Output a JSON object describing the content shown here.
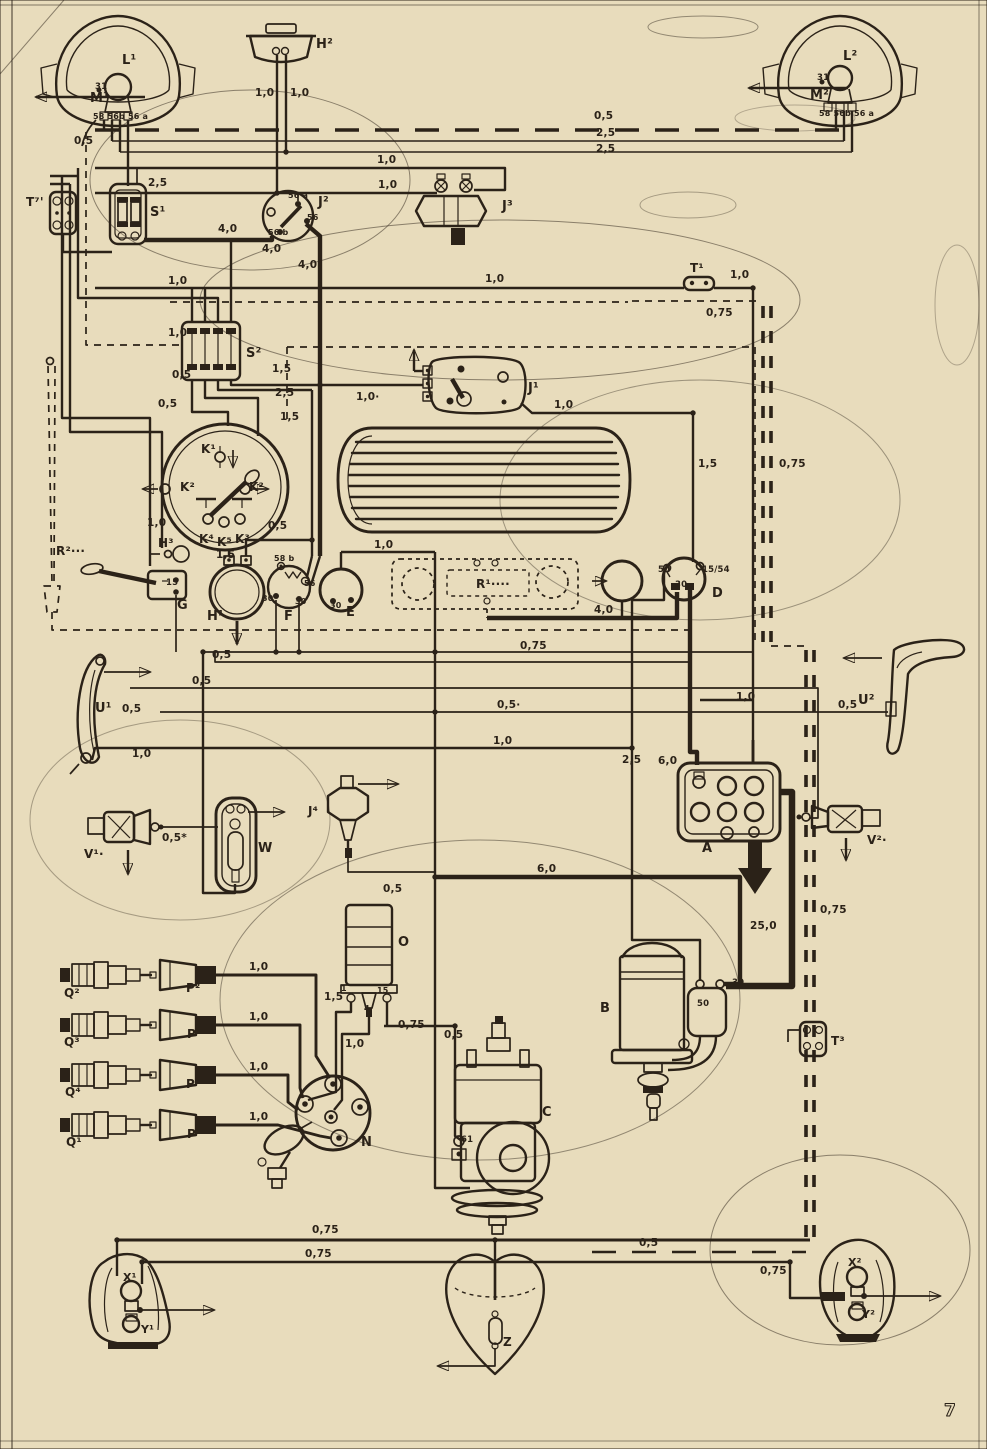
{
  "page": {
    "number": "7"
  },
  "palette": {
    "paper": "#e8dcbc",
    "ink": "#2b2218",
    "smudge": "#9dc9bd"
  },
  "diagram": {
    "labels": [
      {
        "id": "l1",
        "t": "L¹",
        "x": 122,
        "y": 64,
        "s": 13
      },
      {
        "id": "m1",
        "t": "M¹",
        "x": 90,
        "y": 102,
        "s": 13
      },
      {
        "id": "l1-31",
        "t": "31",
        "x": 95,
        "y": 89,
        "s": 8.5
      },
      {
        "id": "l1-58",
        "t": "58 56b 56 a",
        "x": 93,
        "y": 119,
        "s": 8
      },
      {
        "id": "w-l1-05",
        "t": "0,5",
        "x": 74,
        "y": 144,
        "s": 10.5
      },
      {
        "id": "h2",
        "t": "H²",
        "x": 316,
        "y": 48,
        "s": 13
      },
      {
        "id": "w-h2-10a",
        "t": "1,0",
        "x": 255,
        "y": 96,
        "s": 10.5
      },
      {
        "id": "w-h2-10b",
        "t": "1,0",
        "x": 290,
        "y": 96,
        "s": 10.5
      },
      {
        "id": "l2",
        "t": "L²",
        "x": 843,
        "y": 60,
        "s": 13
      },
      {
        "id": "l2-31",
        "t": "31",
        "x": 817,
        "y": 80,
        "s": 8.5
      },
      {
        "id": "m2",
        "t": "M²",
        "x": 810,
        "y": 99,
        "s": 13
      },
      {
        "id": "l2-58",
        "t": "58 56b 56 a",
        "x": 819,
        "y": 116,
        "s": 8
      },
      {
        "id": "w-top-05",
        "t": "0,5",
        "x": 594,
        "y": 119,
        "s": 10.5
      },
      {
        "id": "w-top-25a",
        "t": "2,5",
        "x": 596,
        "y": 136,
        "s": 10.5
      },
      {
        "id": "w-top-25b",
        "t": "2,5",
        "x": 596,
        "y": 152,
        "s": 10.5
      },
      {
        "id": "j3",
        "t": "J³",
        "x": 502,
        "y": 210,
        "s": 13
      },
      {
        "id": "w-j3-10a",
        "t": "1,0",
        "x": 377,
        "y": 163,
        "s": 10.5
      },
      {
        "id": "w-j3-10b",
        "t": "1,0",
        "x": 378,
        "y": 188,
        "s": 10.5
      },
      {
        "id": "t7",
        "t": "T⁷'",
        "x": 26,
        "y": 206,
        "s": 12
      },
      {
        "id": "s1",
        "t": "S¹",
        "x": 150,
        "y": 216,
        "s": 13
      },
      {
        "id": "w-s1-25",
        "t": "2,5",
        "x": 148,
        "y": 186,
        "s": 10.5
      },
      {
        "id": "j2",
        "t": "J²",
        "x": 318,
        "y": 206,
        "s": 13
      },
      {
        "id": "j2-56a",
        "t": "56 a",
        "x": 288,
        "y": 198,
        "s": 8
      },
      {
        "id": "j2-56",
        "t": "56",
        "x": 307,
        "y": 220,
        "s": 8
      },
      {
        "id": "j2-56b",
        "t": "56 b",
        "x": 268,
        "y": 235,
        "s": 8
      },
      {
        "id": "w-j2-40a",
        "t": "4,0",
        "x": 218,
        "y": 232,
        "s": 10.5
      },
      {
        "id": "w-j2-40b",
        "t": "4,0",
        "x": 262,
        "y": 252,
        "s": 10.5
      },
      {
        "id": "w-j2-40c",
        "t": "4,0",
        "x": 298,
        "y": 268,
        "s": 10.5
      },
      {
        "id": "t1",
        "t": "T¹",
        "x": 690,
        "y": 272,
        "s": 12
      },
      {
        "id": "w-t1-10",
        "t": "1,0",
        "x": 730,
        "y": 278,
        "s": 10.5
      },
      {
        "id": "w-t1-075",
        "t": "0,75",
        "x": 706,
        "y": 316,
        "s": 10.5
      },
      {
        "id": "w-mid-10",
        "t": "1,0",
        "x": 485,
        "y": 282,
        "s": 10.5
      },
      {
        "id": "w-left-10",
        "t": "1,0",
        "x": 168,
        "y": 284,
        "s": 10.5
      },
      {
        "id": "s2",
        "t": "S²",
        "x": 246,
        "y": 357,
        "s": 13
      },
      {
        "id": "w-s2-15a",
        "t": "1,5",
        "x": 272,
        "y": 372,
        "s": 10.5
      },
      {
        "id": "w-s2-25",
        "t": "2,5",
        "x": 275,
        "y": 396,
        "s": 10.5
      },
      {
        "id": "w-s2-15b",
        "t": "1,5",
        "x": 280,
        "y": 420,
        "s": 10.5
      },
      {
        "id": "w-s2-05a",
        "t": "0,5",
        "x": 172,
        "y": 378,
        "s": 10.5
      },
      {
        "id": "w-s2-05b",
        "t": "0,5",
        "x": 158,
        "y": 407,
        "s": 10.5
      },
      {
        "id": "w-s2-10",
        "t": "1,0",
        "x": 168,
        "y": 336,
        "s": 10.5
      },
      {
        "id": "j1",
        "t": "J¹",
        "x": 528,
        "y": 392,
        "s": 13
      },
      {
        "id": "w-j1-10a",
        "t": "1,0·",
        "x": 356,
        "y": 400,
        "s": 10.5
      },
      {
        "id": "w-j1-10b",
        "t": "1,0",
        "x": 554,
        "y": 408,
        "s": 10.5
      },
      {
        "id": "w-r-15",
        "t": "1,5",
        "x": 698,
        "y": 467,
        "s": 10.5
      },
      {
        "id": "w-r-075",
        "t": "0,75",
        "x": 779,
        "y": 467,
        "s": 10.5
      },
      {
        "id": "k1",
        "t": "K¹",
        "x": 201,
        "y": 453,
        "s": 12
      },
      {
        "id": "k2l",
        "t": "K²",
        "x": 180,
        "y": 491,
        "s": 12
      },
      {
        "id": "k2r",
        "t": "K²",
        "x": 249,
        "y": 491,
        "s": 12
      },
      {
        "id": "k4",
        "t": "K⁴",
        "x": 199,
        "y": 543,
        "s": 12
      },
      {
        "id": "k5",
        "t": "K⁵",
        "x": 217,
        "y": 546,
        "s": 12
      },
      {
        "id": "k3",
        "t": "K³",
        "x": 235,
        "y": 543,
        "s": 12
      },
      {
        "id": "w-cl-05",
        "t": "0,5",
        "x": 268,
        "y": 529,
        "s": 10.5
      },
      {
        "id": "w-cl-10",
        "t": "1,0",
        "x": 147,
        "y": 526,
        "s": 10.5
      },
      {
        "id": "h3",
        "t": "H³",
        "x": 158,
        "y": 547,
        "s": 12
      },
      {
        "id": "g",
        "t": "G",
        "x": 177,
        "y": 609,
        "s": 13
      },
      {
        "id": "g-15",
        "t": "15",
        "x": 166,
        "y": 585,
        "s": 8.5
      },
      {
        "id": "h1",
        "t": "H¹",
        "x": 207,
        "y": 620,
        "s": 13
      },
      {
        "id": "w-h1-15",
        "t": "1,5",
        "x": 216,
        "y": 558,
        "s": 10.5
      },
      {
        "id": "f",
        "t": "F",
        "x": 284,
        "y": 620,
        "s": 13
      },
      {
        "id": "f-58b",
        "t": "58 b",
        "x": 274,
        "y": 561,
        "s": 8
      },
      {
        "id": "f-56",
        "t": "56",
        "x": 304,
        "y": 586,
        "s": 8
      },
      {
        "id": "f-30a",
        "t": "30",
        "x": 262,
        "y": 601,
        "s": 8
      },
      {
        "id": "f-30b",
        "t": "30",
        "x": 295,
        "y": 604,
        "s": 8
      },
      {
        "id": "e",
        "t": "E",
        "x": 346,
        "y": 616,
        "s": 13
      },
      {
        "id": "e-30",
        "t": "30",
        "x": 330,
        "y": 608,
        "s": 8
      },
      {
        "id": "w-e-10",
        "t": "1,0",
        "x": 374,
        "y": 548,
        "s": 10.5
      },
      {
        "id": "r1",
        "t": "R¹····",
        "x": 476,
        "y": 588,
        "s": 12
      },
      {
        "id": "w-d-40",
        "t": "4,0",
        "x": 594,
        "y": 613,
        "s": 10.5
      },
      {
        "id": "w-mid-075",
        "t": "0,75",
        "x": 520,
        "y": 649,
        "s": 10.5
      },
      {
        "id": "d",
        "t": "D",
        "x": 712,
        "y": 597,
        "s": 13
      },
      {
        "id": "d-50",
        "t": "50",
        "x": 658,
        "y": 572,
        "s": 8.5
      },
      {
        "id": "d-30",
        "t": "30",
        "x": 675,
        "y": 587,
        "s": 8.5
      },
      {
        "id": "d-1554",
        "t": "15/54",
        "x": 702,
        "y": 572,
        "s": 8.5
      },
      {
        "id": "r2",
        "t": "R²···",
        "x": 56,
        "y": 555,
        "s": 12
      },
      {
        "id": "u1",
        "t": "U¹",
        "x": 95,
        "y": 712,
        "s": 13
      },
      {
        "id": "w-u1-05",
        "t": "0,5",
        "x": 122,
        "y": 712,
        "s": 10.5
      },
      {
        "id": "w-u1-10",
        "t": "1,0",
        "x": 132,
        "y": 757,
        "s": 10.5
      },
      {
        "id": "w-run-05a",
        "t": "0,5",
        "x": 212,
        "y": 658,
        "s": 10.5
      },
      {
        "id": "w-run-05b",
        "t": "0,5",
        "x": 192,
        "y": 684,
        "s": 10.5
      },
      {
        "id": "w-run-05c",
        "t": "0,5·",
        "x": 497,
        "y": 708,
        "s": 10.5
      },
      {
        "id": "w-run-10",
        "t": "1,0",
        "x": 493,
        "y": 744,
        "s": 10.5
      },
      {
        "id": "u2",
        "t": "U²",
        "x": 858,
        "y": 704,
        "s": 13
      },
      {
        "id": "w-u2-05",
        "t": "0,5",
        "x": 838,
        "y": 708,
        "s": 10.5
      },
      {
        "id": "w-u2-10",
        "t": "1,0",
        "x": 736,
        "y": 700,
        "s": 10.5
      },
      {
        "id": "a",
        "t": "A",
        "x": 702,
        "y": 852,
        "s": 13
      },
      {
        "id": "w-a-60",
        "t": "6,0",
        "x": 658,
        "y": 764,
        "s": 10.5
      },
      {
        "id": "w-a-25",
        "t": "2,5",
        "x": 622,
        "y": 763,
        "s": 10.5
      },
      {
        "id": "v1",
        "t": "V¹·",
        "x": 84,
        "y": 858,
        "s": 12
      },
      {
        "id": "w-v1-05",
        "t": "0,5*",
        "x": 162,
        "y": 841,
        "s": 10.5
      },
      {
        "id": "w",
        "t": "W",
        "x": 258,
        "y": 852,
        "s": 13
      },
      {
        "id": "j4",
        "t": "J⁴",
        "x": 308,
        "y": 815,
        "s": 12
      },
      {
        "id": "w-j4-05",
        "t": "0,5",
        "x": 383,
        "y": 892,
        "s": 10.5
      },
      {
        "id": "v2",
        "t": "V²·",
        "x": 867,
        "y": 844,
        "s": 12
      },
      {
        "id": "w-250",
        "t": "25,0",
        "x": 750,
        "y": 929,
        "s": 10.5
      },
      {
        "id": "w-rr-075",
        "t": "0,75",
        "x": 820,
        "y": 913,
        "s": 10.5
      },
      {
        "id": "w-60-mid",
        "t": "6,0",
        "x": 537,
        "y": 872,
        "s": 10.5
      },
      {
        "id": "o",
        "t": "O",
        "x": 398,
        "y": 946,
        "s": 13
      },
      {
        "id": "o-1",
        "t": "1",
        "x": 341,
        "y": 991,
        "s": 8
      },
      {
        "id": "o-15",
        "t": "15",
        "x": 377,
        "y": 993,
        "s": 8
      },
      {
        "id": "o-4",
        "t": "4",
        "x": 364,
        "y": 1011,
        "s": 8
      },
      {
        "id": "w-o-15g",
        "t": "1,5",
        "x": 324,
        "y": 1000,
        "s": 10.5
      },
      {
        "id": "w-o-10",
        "t": "1,0",
        "x": 345,
        "y": 1047,
        "s": 10.5
      },
      {
        "id": "w-o-075",
        "t": "0,75",
        "x": 398,
        "y": 1028,
        "s": 10.5
      },
      {
        "id": "w-c-05",
        "t": "0,5",
        "x": 444,
        "y": 1038,
        "s": 10.5
      },
      {
        "id": "b",
        "t": "B",
        "x": 600,
        "y": 1012,
        "s": 13
      },
      {
        "id": "b-50",
        "t": "50",
        "x": 697,
        "y": 1006,
        "s": 8.5
      },
      {
        "id": "b-30",
        "t": "30",
        "x": 732,
        "y": 985,
        "s": 8.5
      },
      {
        "id": "t3",
        "t": "T³",
        "x": 831,
        "y": 1045,
        "s": 12
      },
      {
        "id": "c",
        "t": "C",
        "x": 542,
        "y": 1116,
        "s": 13
      },
      {
        "id": "c-61",
        "t": "61",
        "x": 461,
        "y": 1142,
        "s": 8.5
      },
      {
        "id": "n",
        "t": "N",
        "x": 361,
        "y": 1146,
        "s": 13
      },
      {
        "id": "q2",
        "t": "Q²",
        "x": 64,
        "y": 997,
        "s": 12
      },
      {
        "id": "q3",
        "t": "Q³",
        "x": 64,
        "y": 1046,
        "s": 12
      },
      {
        "id": "q4",
        "t": "Q⁴",
        "x": 65,
        "y": 1096,
        "s": 12
      },
      {
        "id": "q1",
        "t": "Q¹",
        "x": 66,
        "y": 1146,
        "s": 12
      },
      {
        "id": "p2",
        "t": "P²",
        "x": 186,
        "y": 992,
        "s": 12
      },
      {
        "id": "p3",
        "t": "P³",
        "x": 187,
        "y": 1038,
        "s": 12
      },
      {
        "id": "p4",
        "t": "P⁴",
        "x": 186,
        "y": 1088,
        "s": 12
      },
      {
        "id": "p1",
        "t": "P¹",
        "x": 187,
        "y": 1138,
        "s": 12
      },
      {
        "id": "w-p2-10",
        "t": "1,0",
        "x": 249,
        "y": 970,
        "s": 10.5
      },
      {
        "id": "w-p3-10",
        "t": "1,0",
        "x": 249,
        "y": 1020,
        "s": 10.5
      },
      {
        "id": "w-p4-10",
        "t": "1,0",
        "x": 249,
        "y": 1070,
        "s": 10.5
      },
      {
        "id": "w-p1-10",
        "t": "1,0",
        "x": 249,
        "y": 1120,
        "s": 10.5
      },
      {
        "id": "w-bl-075a",
        "t": "0,75",
        "x": 312,
        "y": 1233,
        "s": 10.5
      },
      {
        "id": "w-bl-075b",
        "t": "0,75",
        "x": 305,
        "y": 1257,
        "s": 10.5
      },
      {
        "id": "w-bz-05",
        "t": "0,5",
        "x": 639,
        "y": 1246,
        "s": 10.5
      },
      {
        "id": "w-br-075",
        "t": "0,75",
        "x": 760,
        "y": 1274,
        "s": 10.5
      },
      {
        "id": "x1",
        "t": "X¹",
        "x": 123,
        "y": 1281,
        "s": 11
      },
      {
        "id": "y1",
        "t": "Y¹",
        "x": 141,
        "y": 1333,
        "s": 11
      },
      {
        "id": "z",
        "t": "Z",
        "x": 503,
        "y": 1346,
        "s": 12
      },
      {
        "id": "x2",
        "t": "X²",
        "x": 848,
        "y": 1266,
        "s": 11
      },
      {
        "id": "y2",
        "t": "Y²",
        "x": 862,
        "y": 1318,
        "s": 11
      }
    ]
  }
}
